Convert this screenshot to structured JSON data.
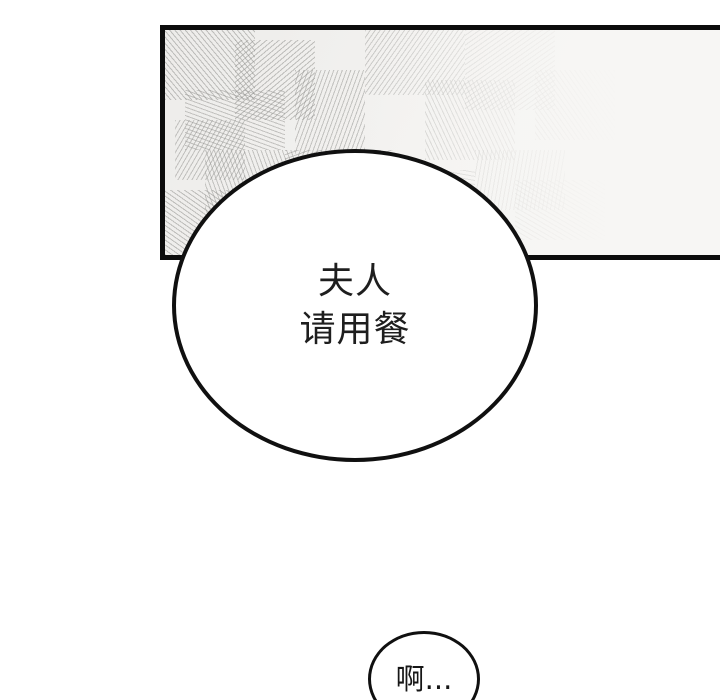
{
  "page": {
    "background_color": "#ffffff"
  },
  "panel": {
    "border_color": "#0c0c0c",
    "background_left": "#edecea",
    "background_right": "#f9f8f6",
    "texture_line_color": "#94948f",
    "texture_style": "hand-drawn hatch lines fading toward the right"
  },
  "speech_bubbles": {
    "main": {
      "line1": "夫人",
      "line2": "请用餐",
      "fill_color": "#ffffff",
      "border_color": "#101010",
      "text_color": "#1e1e1e"
    },
    "small": {
      "text": "啊...",
      "fill_color": "#ffffff",
      "border_color": "#101010",
      "text_color": "#161616"
    }
  }
}
